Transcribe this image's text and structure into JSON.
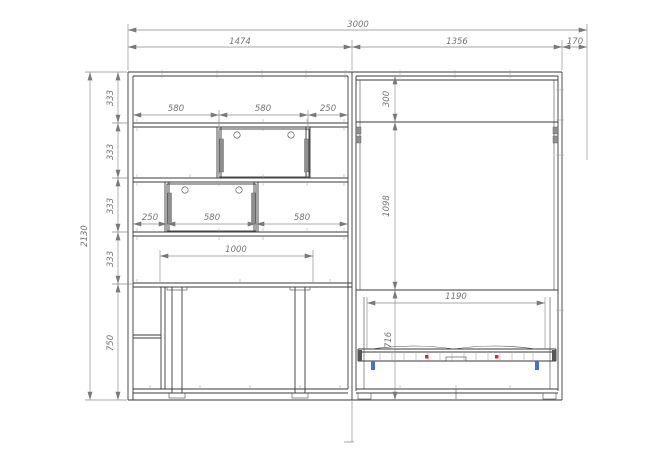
{
  "colors": {
    "line": "#3a3a3a",
    "dim": "#7a7a7a",
    "accent_red": "#cf3333",
    "accent_blue": "#4a6fd4",
    "background": "#ffffff"
  },
  "dimensions": {
    "top": {
      "overall": "3000",
      "left_unit": "1474",
      "bed_unit": "1356",
      "side": "170"
    },
    "height": {
      "overall": "2130",
      "row1": "333",
      "row2": "333",
      "row3": "333",
      "row4": "333",
      "base": "750"
    },
    "upper_row": {
      "a": "580",
      "b": "580",
      "c": "250"
    },
    "middle_row": {
      "a": "250",
      "b": "580",
      "c": "580"
    },
    "desk": {
      "width": "1000"
    },
    "bed": {
      "top_gap": "300",
      "door_height": "1098",
      "inner_width": "1190",
      "base_height": "716"
    }
  }
}
